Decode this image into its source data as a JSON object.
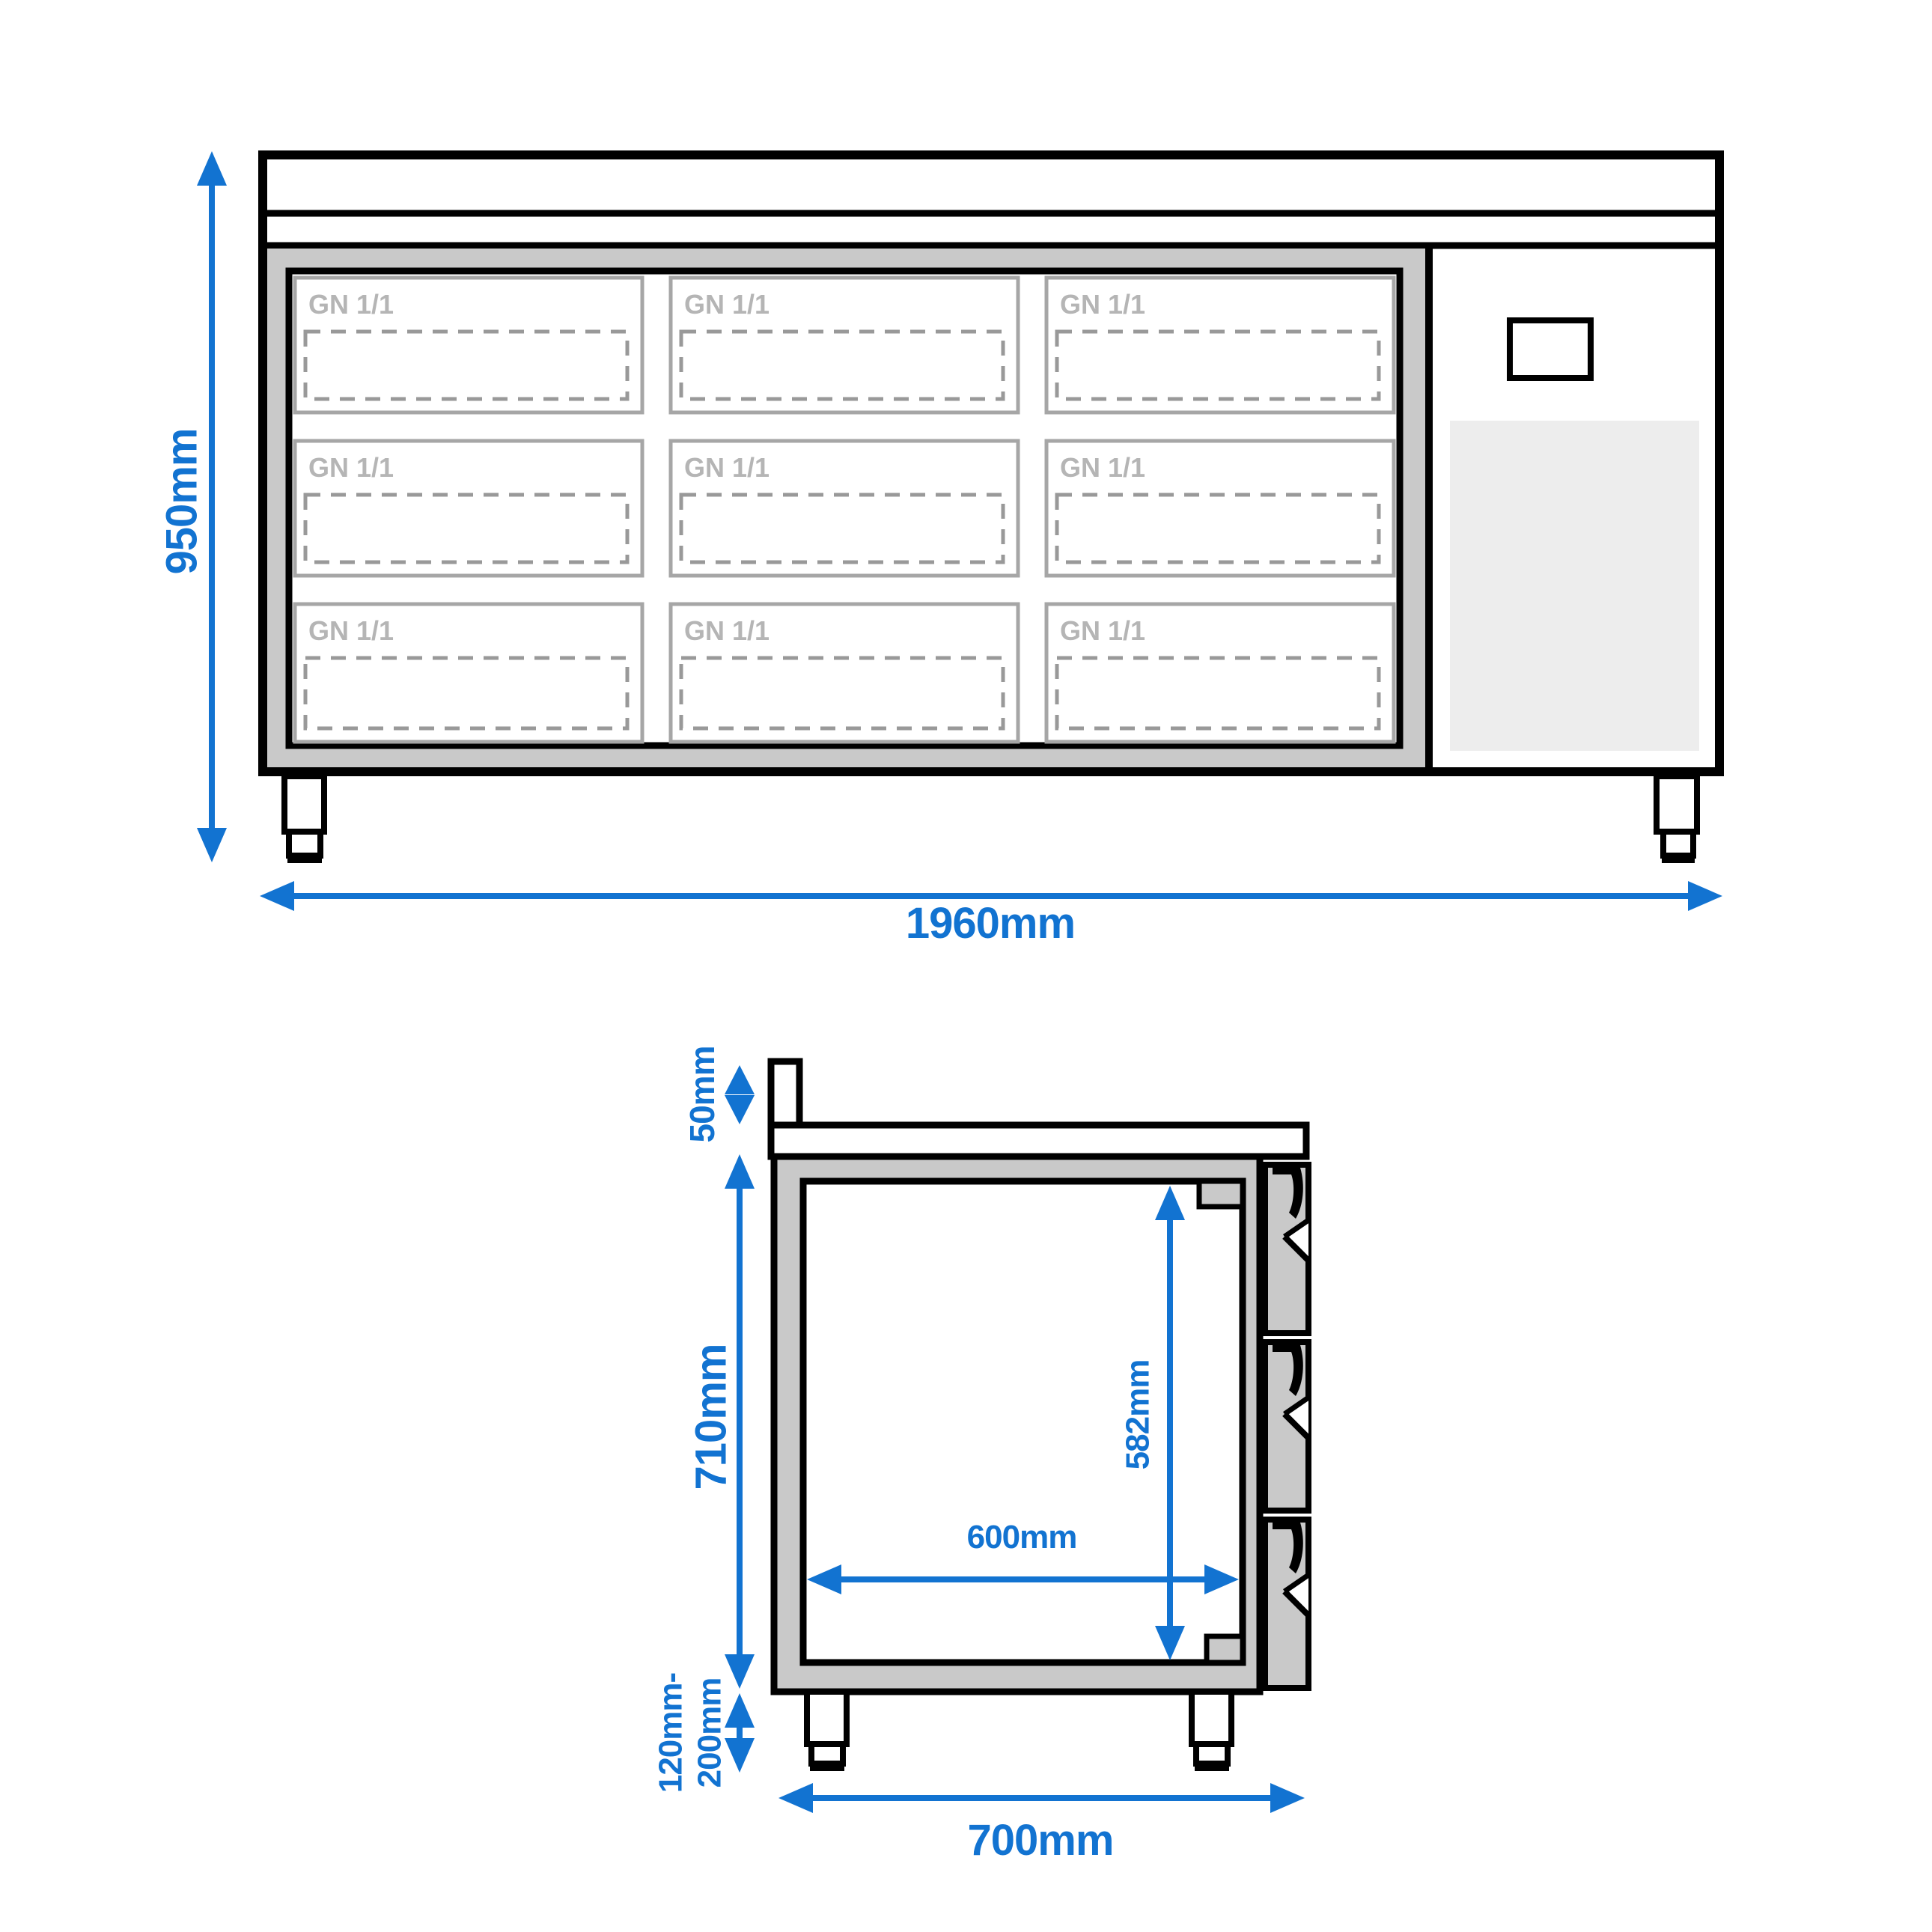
{
  "front_view": {
    "height_label": "950mm",
    "width_label": "1960mm",
    "gn_label": "GN 1/1"
  },
  "side_view": {
    "upstand_label": "50mm",
    "body_height_label": "710mm",
    "leg_height_label_line1": "120mm-",
    "leg_height_label_line2": "200mm",
    "inner_depth_label": "600mm",
    "inner_height_label": "582mm",
    "depth_label": "700mm"
  },
  "colors": {
    "dimension_blue": "#1273d1",
    "panel_gray": "#c9c9c9",
    "vent_gray": "#ededed",
    "gn_text_gray": "#b5b5b5",
    "dashed_outline_gray": "#999999",
    "line_black": "#000000"
  }
}
